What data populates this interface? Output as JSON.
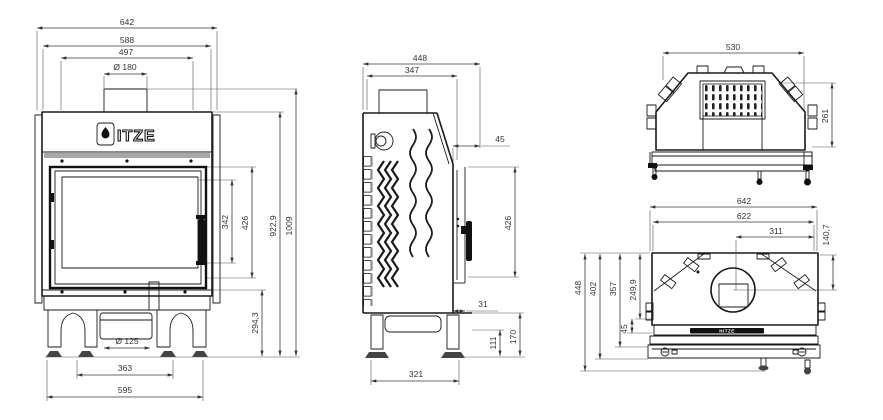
{
  "drawing": {
    "brand": {
      "name": "HITZE",
      "logo_rest": "ITZE"
    },
    "views": {
      "front": {
        "dims": {
          "overall_width": "642",
          "upper_width": "588",
          "inner_width": "497",
          "flue_diameter": "Ø 180",
          "glass_height": "342",
          "door_height": "426",
          "body_height": "922,9",
          "overall_height": "1009",
          "base_height": "294,3",
          "intake_diameter": "Ø 125",
          "leg_spacing": "363",
          "base_width": "595"
        }
      },
      "side": {
        "dims": {
          "overall_depth": "448",
          "body_depth": "347",
          "front_frame_depth": "45",
          "door_height": "426",
          "bottom_lip": "31",
          "leg_height": "111",
          "base_height": "170",
          "base_depth": "321"
        }
      },
      "rear_top": {
        "dims": {
          "top_width": "530",
          "depth": "261"
        }
      },
      "top": {
        "dims": {
          "overall_width": "642",
          "body_width": "622",
          "flue_offset_right": "311",
          "flue_center_depth": "140,7",
          "overall_depth": "448",
          "frame_depth": "402",
          "body_front_depth": "357",
          "flue_depth": "249,9",
          "front_gap": "45"
        }
      }
    }
  }
}
